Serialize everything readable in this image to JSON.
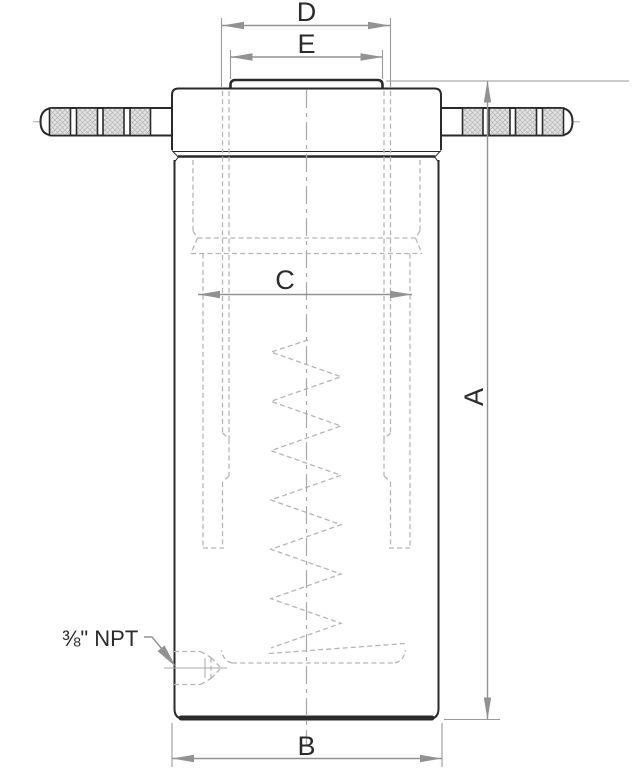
{
  "drawing": {
    "dimension_labels": {
      "a": "A",
      "b": "B",
      "c": "C",
      "d": "D",
      "e": "E"
    },
    "port_label": "⅜\" NPT",
    "colors": {
      "outline": "#2a2a2a",
      "hidden_line": "#b6b6b6",
      "centerline": "#a9a9a9",
      "dimension_line": "#929292",
      "label_text": "#2b2b2b",
      "knurl_fill": "#e2e2e2",
      "background": "#ffffff"
    }
  }
}
